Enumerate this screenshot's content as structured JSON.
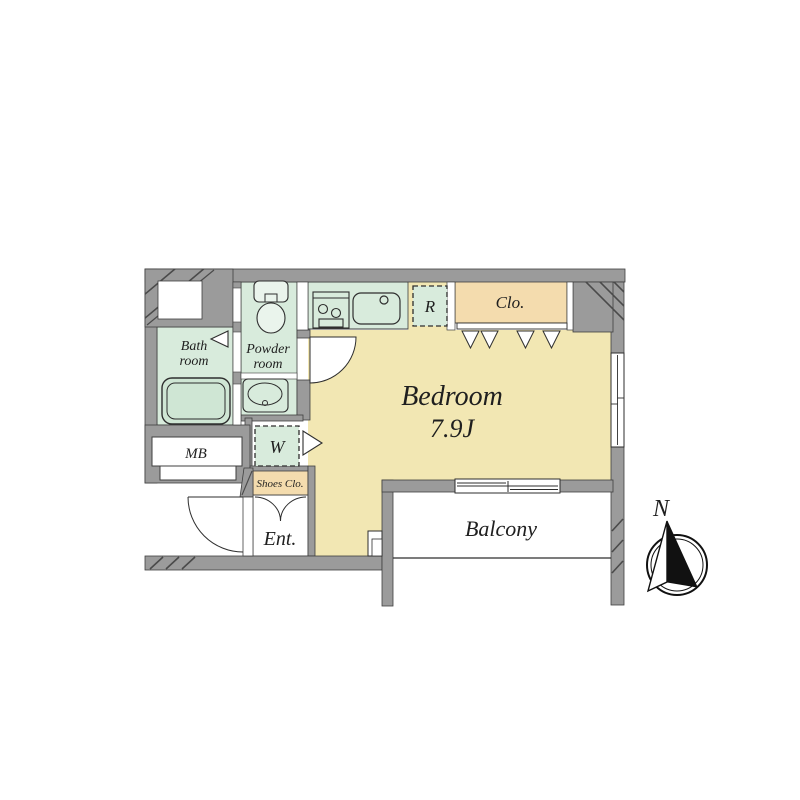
{
  "plan": {
    "bedroom_label": "Bedroom",
    "bedroom_size": "7.9J",
    "bath_line1": "Bath",
    "bath_line2": "room",
    "powder_line1": "Powder",
    "powder_line2": "room",
    "balcony_label": "Balcony",
    "entrance_label": "Ent.",
    "closet_label": "Clo.",
    "shoes_closet_label": "Shoes Clo.",
    "meter_box_label": "MB",
    "washer_label": "W",
    "refrigerator_label": "R"
  },
  "compass": {
    "north_label": "N"
  },
  "colors": {
    "wall": "#9b9b9b",
    "room_green": "#d8ebdc",
    "fixture_green": "#cfe6d4",
    "bedroom_cream": "#f2e7b3",
    "closet_tan": "#f4dcae",
    "outline": "#3f3f3f",
    "white": "#ffffff"
  }
}
